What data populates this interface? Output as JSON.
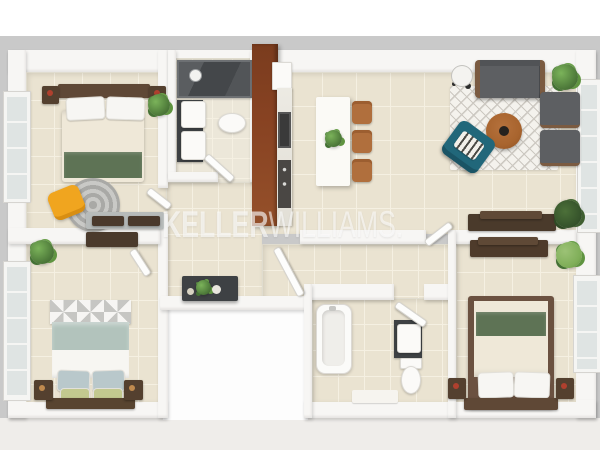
{
  "image": {
    "type": "3d-floor-plan-render",
    "view": "top-down dollhouse",
    "description": "3D rendered apartment floor plan: three bedrooms, two bathrooms, kitchen with open dining and living area, connecting hallway"
  },
  "watermark": {
    "brand_primary": "KELLER",
    "brand_secondary": "WILLIAMS.",
    "color": "rgba(255,255,255,0.62)"
  },
  "palette": {
    "bg_outer": "#c9c9c9",
    "bg_top": "#ffffff",
    "bg_bottom": "#efedea",
    "wall": "#f7f6f4",
    "floor": "#eae3d1",
    "floor_line": "#f5f0e2",
    "wood_dark": "#54402f",
    "wood_red": "#874222",
    "wood_mid": "#a8642e",
    "chair_tan": "#b06f3d",
    "green_bed": "#5e7355",
    "sage": "#b2c3bc",
    "teal": "#21677a",
    "yellow": "#f0a51f",
    "gray_sofa": "#5d5f62",
    "charcoal": "#3e4144",
    "cream": "#efe8d8",
    "plant": "#4e7a3a",
    "rug_base": "#f4f2ed",
    "rug_line": "#ccc8c1",
    "watermark": "rgba(255,255,255,0.62)"
  },
  "rooms": [
    {
      "id": "bedroom-top-left",
      "furniture": [
        "double-bed-green-throw",
        "headboard",
        "nightstand-left",
        "nightstand-right",
        "plant",
        "round-gray-rug",
        "yellow-chair",
        "desk",
        "window-left",
        "door"
      ]
    },
    {
      "id": "bathroom-top",
      "furniture": [
        "shower-dark-glass",
        "shower-head",
        "vanity-sink-upper",
        "vanity-sink-lower",
        "toilet",
        "door"
      ]
    },
    {
      "id": "kitchen",
      "furniture": [
        "tall-cabinets-mahogany",
        "range-hood",
        "counter-marble",
        "stove",
        "oven-appliance"
      ]
    },
    {
      "id": "dining-area",
      "furniture": [
        "dining-table-white",
        "plant-centerpiece",
        "chair-1",
        "chair-2",
        "chair-3"
      ]
    },
    {
      "id": "living-room",
      "furniture": [
        "sofa-gray",
        "floor-lamp",
        "plant-top-right",
        "lattice-rug",
        "coffee-table-round",
        "armchair-1",
        "armchair-2",
        "accent-chair-teal",
        "striped-cushion",
        "sideboard",
        "plant-bottom-right",
        "glass-door-right"
      ]
    },
    {
      "id": "hallway",
      "furniture": [
        "console-table",
        "console-decor",
        "door-to-living",
        "door-to-bedroom"
      ]
    },
    {
      "id": "bedroom-bottom-left",
      "furniture": [
        "double-bed-sage",
        "zigzag-runner",
        "pillows-blue",
        "pillows-green",
        "nightstand-left",
        "nightstand-right",
        "wall-shelf",
        "plant",
        "window-left",
        "door"
      ]
    },
    {
      "id": "bathroom-bottom",
      "furniture": [
        "bathtub",
        "vanity-dark",
        "toilet",
        "bath-mat",
        "door"
      ]
    },
    {
      "id": "bedroom-bottom-right",
      "furniture": [
        "double-bed-green-band",
        "pillows-white",
        "nightstand-left",
        "nightstand-right",
        "dresser",
        "plant",
        "window-right"
      ]
    }
  ]
}
